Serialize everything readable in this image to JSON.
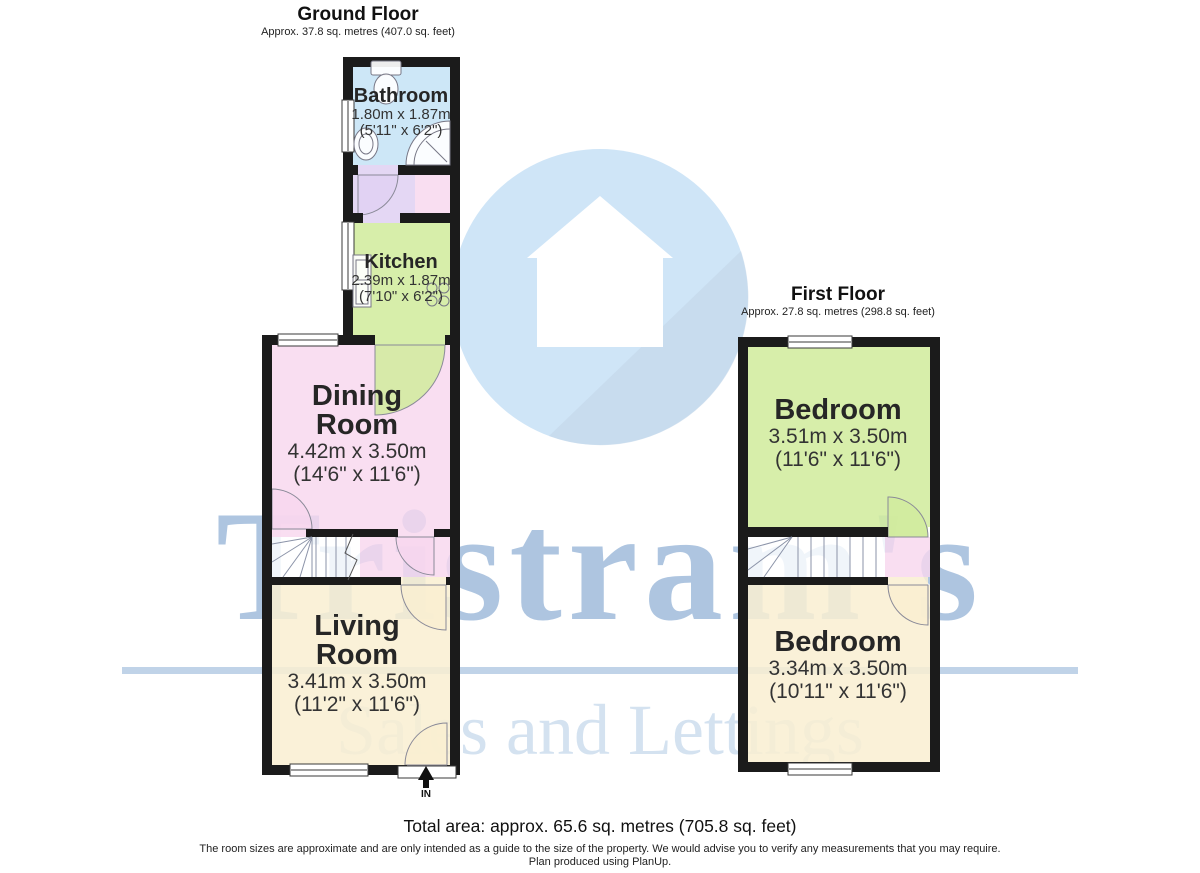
{
  "watermark": {
    "brand": "Tristram's",
    "tagline": "Sales and Lettings",
    "brand_color": "#a5c2e0",
    "tagline_color": "#c7d8ea",
    "logo_icon": "house-in-circle-icon",
    "logo_circle_color": "#cfe5f7"
  },
  "ground_floor": {
    "title": "Ground Floor",
    "subtitle": "Approx. 37.8 sq. metres (407.0 sq. feet)",
    "rooms": {
      "bathroom": {
        "name": "Bathroom",
        "metric": "1.80m x 1.87m",
        "imperial": "(5'11\" x 6'2\")",
        "color": "#c6e4f6"
      },
      "kitchen": {
        "name": "Kitchen",
        "metric": "2.39m x 1.87m",
        "imperial": "(7'10\" x 6'2\")",
        "color": "#d1ec9e"
      },
      "dining_room": {
        "name": "Dining Room",
        "metric": "4.42m x 3.50m",
        "imperial": "(14'6\" x 11'6\")",
        "color": "#f8d7ee"
      },
      "living_room": {
        "name": "Living Room",
        "metric": "3.41m x 3.50m",
        "imperial": "(11'2\" x 11'6\")",
        "color": "#f9eed1"
      }
    },
    "hallway_color": "#e0d1f2",
    "entrance_label": "IN"
  },
  "first_floor": {
    "title": "First Floor",
    "subtitle": "Approx. 27.8 sq. metres (298.8 sq. feet)",
    "rooms": {
      "bedroom_1": {
        "name": "Bedroom",
        "metric": "3.51m x 3.50m",
        "imperial": "(11'6\" x 11'6\")",
        "color": "#d1ec9e"
      },
      "bedroom_2": {
        "name": "Bedroom",
        "metric": "3.34m x 3.50m",
        "imperial": "(10'11\" x 11'6\")",
        "color": "#f9eed1"
      }
    },
    "landing_color": "#f8d7ee"
  },
  "footer": {
    "total_area": "Total area: approx. 65.6 sq. metres (705.8 sq. feet)",
    "disclaimer_line1": "The room sizes are approximate and are only intended as a guide to the size of the property. We would advise you to verify any measurements that you may require.",
    "disclaimer_line2": "Plan produced using PlanUp."
  },
  "colors": {
    "wall": "#1b1b1b"
  }
}
